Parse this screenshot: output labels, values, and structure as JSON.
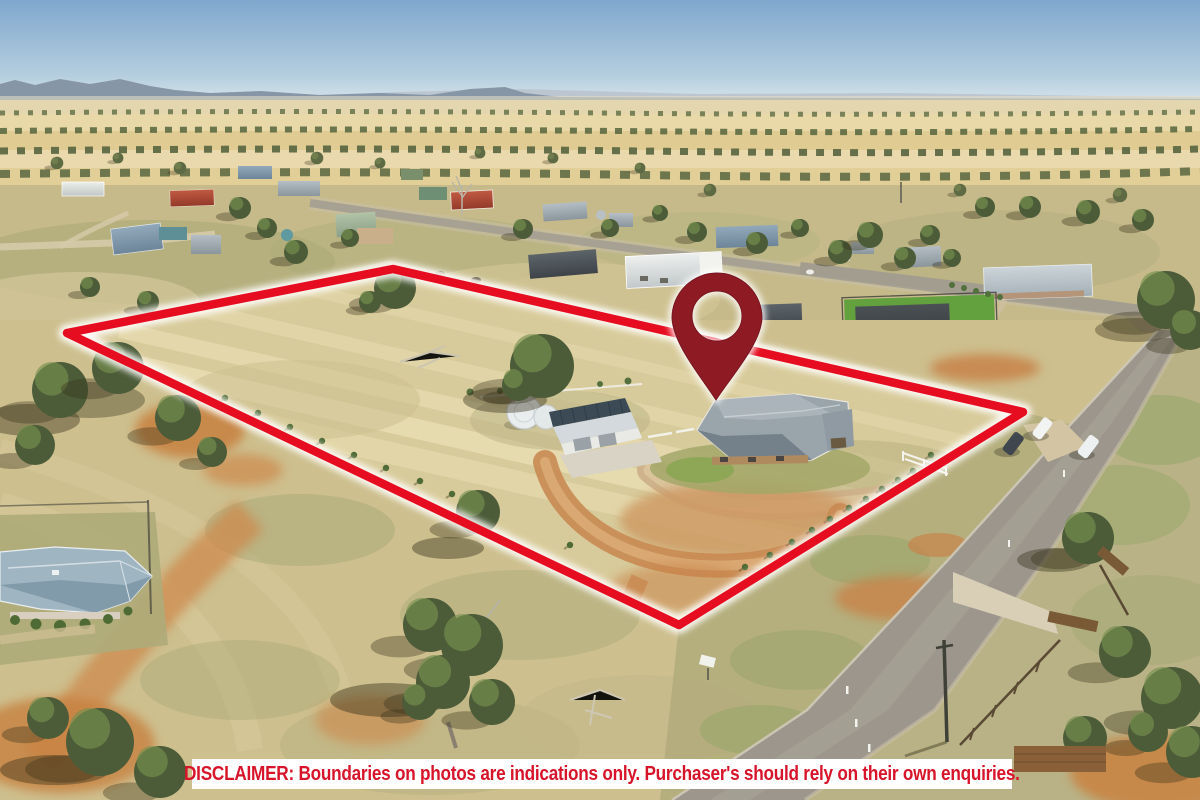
{
  "meta": {
    "description": "Aerial drone photograph of a rural acreage property for sale, boundary outlined in red with a maroon location pin on the homestead",
    "scene": "dry golden farmland, rural residential houses, sheds, gum trees, country road, distant blue hills"
  },
  "disclaimer": {
    "text": "DISCLAIMER: Boundaries on photos are indications only. Purchaser's should rely on their own enquiries."
  },
  "overlay": {
    "boundary_points": "67,333 393,269 1023,412 679,625",
    "pin": {
      "cx": 717,
      "cy": 316,
      "head_radius": 45,
      "hole_radius": 25,
      "tip_x": 716,
      "tip_y": 400,
      "path": "M716,400 C702,378 673,344 672,318 A45,45 0 1 1 762,318 C761,344 730,378 716,400 Z M692,316 a25,25 0 1 0 50,0 a25,25 0 1 0 -50,0 Z"
    }
  },
  "colors": {
    "boundary-red": "#e60d20",
    "pin-maroon": "#8e1b24",
    "disclaimer-red": "#d8142a",
    "banner-white": "#ffffff",
    "sky-blue": "#7fa7cd",
    "hill-blue": "#8796a6",
    "field-gold": "#e2cf97",
    "grass-dry": "#cfc08d",
    "dirt-orange": "#c8834a",
    "road-grey": "#9c968c",
    "tree-green": "#4c5c39",
    "lawn-green": "#63a03e",
    "roof-grey": "#9ba6ad"
  }
}
